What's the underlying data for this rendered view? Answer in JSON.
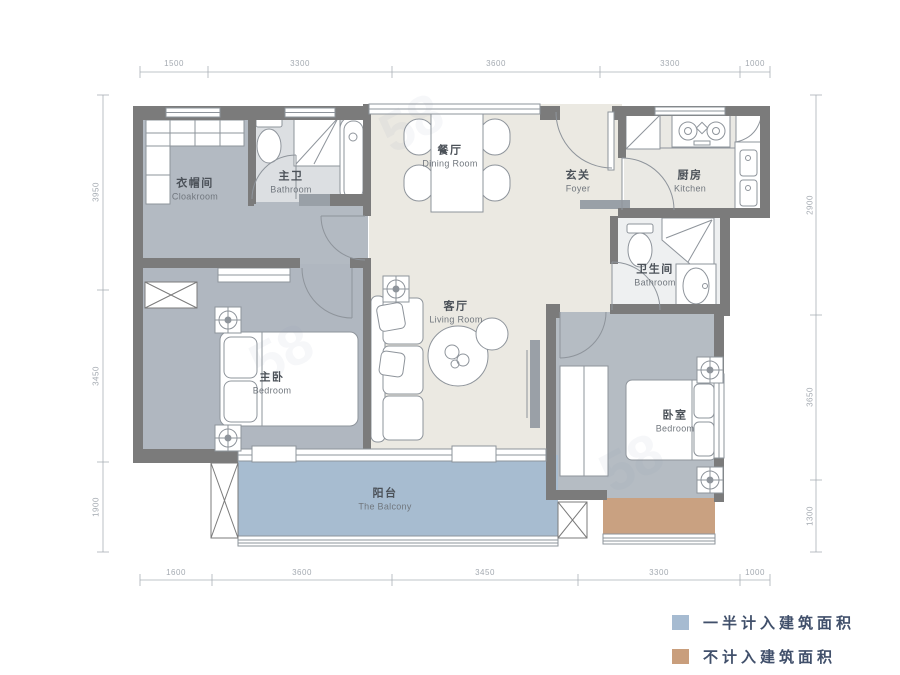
{
  "rooms": {
    "cloakroom": {
      "zh": "衣帽间",
      "en": "Cloakroom"
    },
    "master_bath": {
      "zh": "主卫",
      "en": "Bathroom"
    },
    "dining": {
      "zh": "餐厅",
      "en": "Dining Room"
    },
    "foyer": {
      "zh": "玄关",
      "en": "Foyer"
    },
    "kitchen": {
      "zh": "厨房",
      "en": "Kitchen"
    },
    "bath": {
      "zh": "卫生间",
      "en": "Bathroom"
    },
    "living": {
      "zh": "客厅",
      "en": "Living Room"
    },
    "master_bedroom": {
      "zh": "主卧",
      "en": "Bedroom"
    },
    "bedroom": {
      "zh": "卧室",
      "en": "Bedroom"
    },
    "balcony": {
      "zh": "阳台",
      "en": "The Balcony"
    }
  },
  "dimensions": {
    "top": [
      "1500",
      "3300",
      "3600",
      "3300",
      "1000"
    ],
    "bottom": [
      "1600",
      "3600",
      "3450",
      "3300",
      "1000"
    ],
    "left": [
      "3950",
      "3450",
      "1900"
    ],
    "right": [
      "2900",
      "3650",
      "1300"
    ]
  },
  "legend": {
    "items": [
      {
        "label": "一半计入建筑面积",
        "color": "#a6bbd1"
      },
      {
        "label": "不计入建筑面积",
        "color": "#c99e7c"
      }
    ]
  },
  "colors": {
    "wall": "#7b7b7b",
    "balcony_fill": "#a7bcd0",
    "excluded_fill": "#c9a181",
    "bedroom_fill": "#b0b7c0",
    "living_fill": "#ebe9e2"
  },
  "watermark": "58"
}
